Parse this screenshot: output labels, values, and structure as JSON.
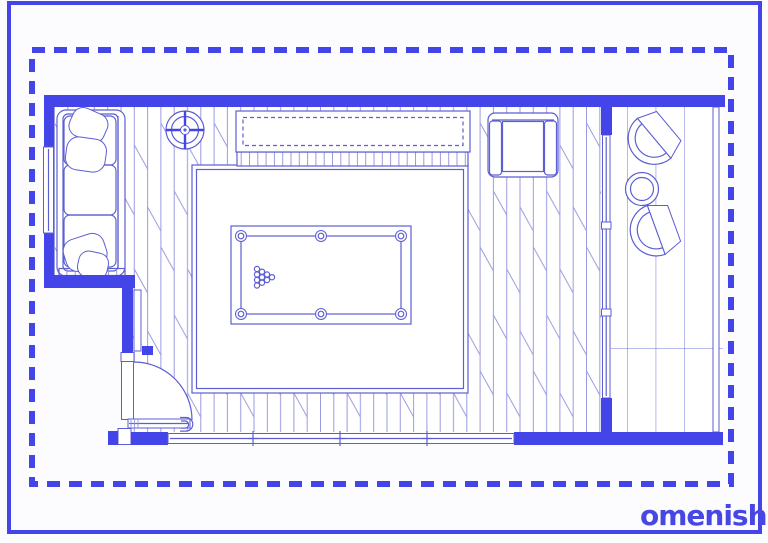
{
  "brand": {
    "name": "Homenish",
    "wordmark_suffix": "omenish"
  },
  "colors": {
    "wall": "#4345e8",
    "line": "#5c5ed3",
    "line_light": "#9a9be0",
    "tile_line": "#7173d8",
    "background": "#fcfcfe",
    "logo": "#4647e4"
  },
  "plan": {
    "type": "floor-plan-blueprint",
    "room_elements": [
      "three-seat-sofa",
      "throw-pillows",
      "left-wall-window",
      "ceiling-light",
      "media-console",
      "armchair",
      "area-rug",
      "pool-table",
      "billiard-ball-rack",
      "entry-door-with-swing",
      "bottom-window-band",
      "glass-partition",
      "tile-floor-nook",
      "tub-chair-upper",
      "tub-chair-lower",
      "round-side-table",
      "wood-plank-floor"
    ]
  }
}
